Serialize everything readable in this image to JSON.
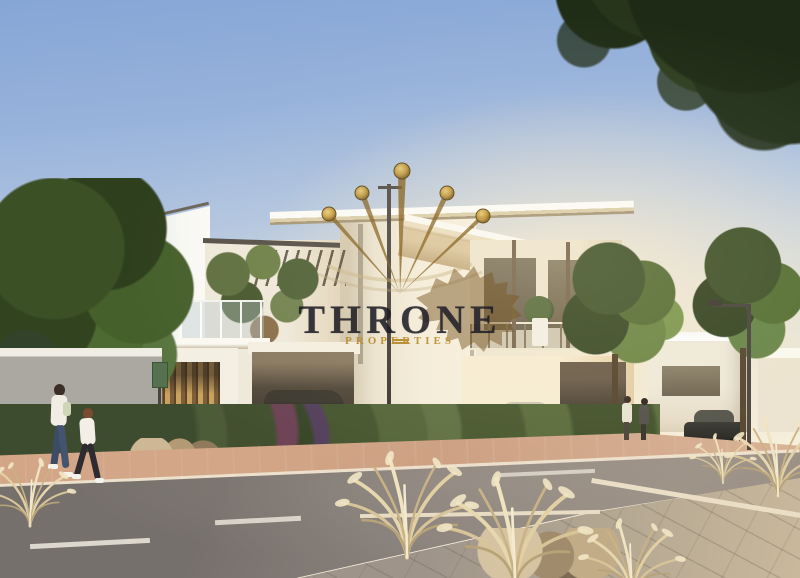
{
  "scene": {
    "alt": "Sunlit architectural rendering of a modern two-storey white villa with carport, balconies, trees, ornamental grasses, parked cars and pedestrians on a street"
  },
  "watermark": {
    "title": "THRONE",
    "subtitle": "PROPERTIES",
    "title_color": "#23222b",
    "gold_text_color": "#b98c2c",
    "crown_gold_color": "#c9a247",
    "lion_color": "#7a5a26"
  },
  "palette": {
    "sky_top": "#86a6d6",
    "sky_horizon": "#f8f1de",
    "wall_white": "#f6f2e8",
    "roof_underside": "#d9c49c",
    "tree_green": "#3f5229",
    "road_gray": "#8a827c",
    "sidewalk_tan": "#cc9f81",
    "pavement_tan": "#b2a691",
    "grass_plume": "#ead9b2",
    "wood_slats": "#c9a25e"
  }
}
